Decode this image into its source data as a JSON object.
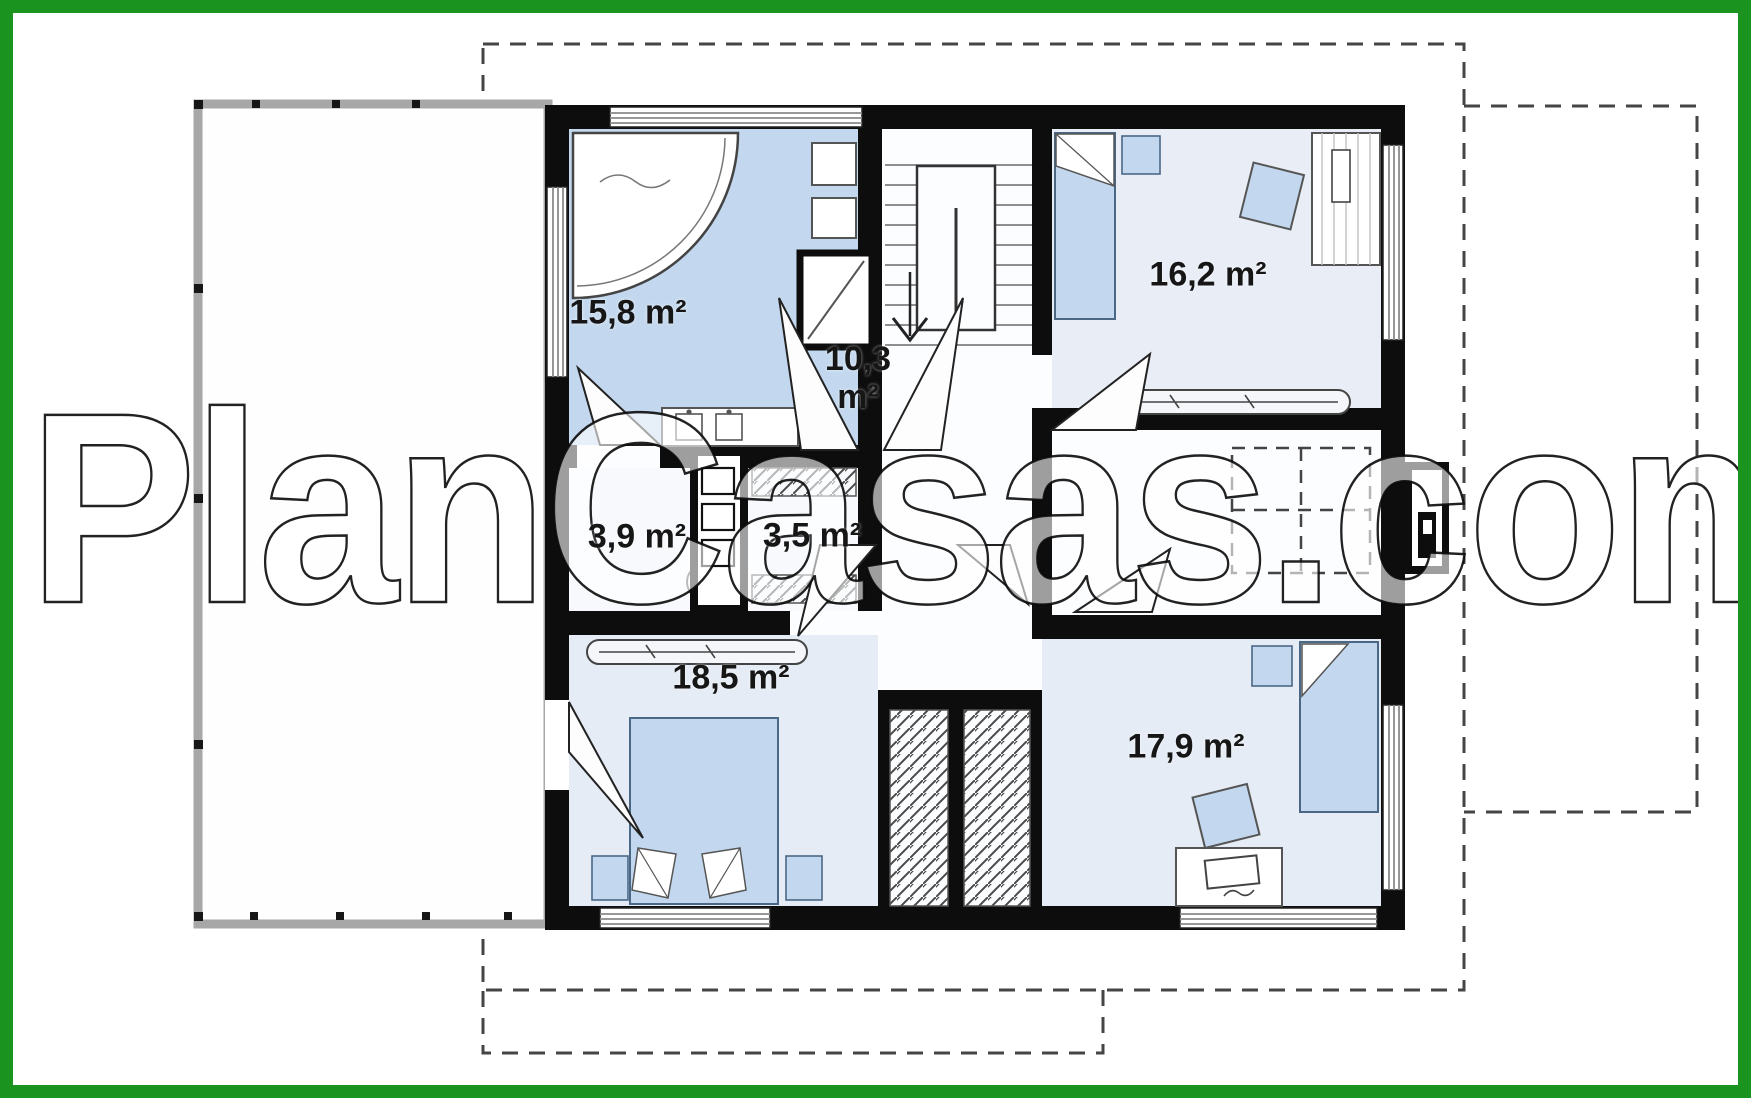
{
  "title": "First floor plan",
  "watermark": {
    "text": "PlanCasas.com"
  },
  "colors": {
    "border_green": "#1a941f",
    "wall_black": "#0d0d0d",
    "bathroom_floor_blue": "#c3d8ee",
    "bedroom_floor_blue": "#e6ecf5",
    "furniture_blue": "#c3d8ee",
    "terrace_rail_gray": "#a7a7a7",
    "dashed_outline_gray": "#454545"
  },
  "rooms": [
    {
      "id": "bathroom",
      "area": "15,8 m²"
    },
    {
      "id": "bedroom-top-right",
      "area": "16,2 m²"
    },
    {
      "id": "hallway-stairs",
      "area": "10,3 m²"
    },
    {
      "id": "wc",
      "area": "3,9 m²"
    },
    {
      "id": "closet",
      "area": "3,5 m²"
    },
    {
      "id": "bedroom-bottom-left",
      "area": "18,5 m²"
    },
    {
      "id": "bedroom-bottom-right",
      "area": "17,9 m²"
    }
  ]
}
